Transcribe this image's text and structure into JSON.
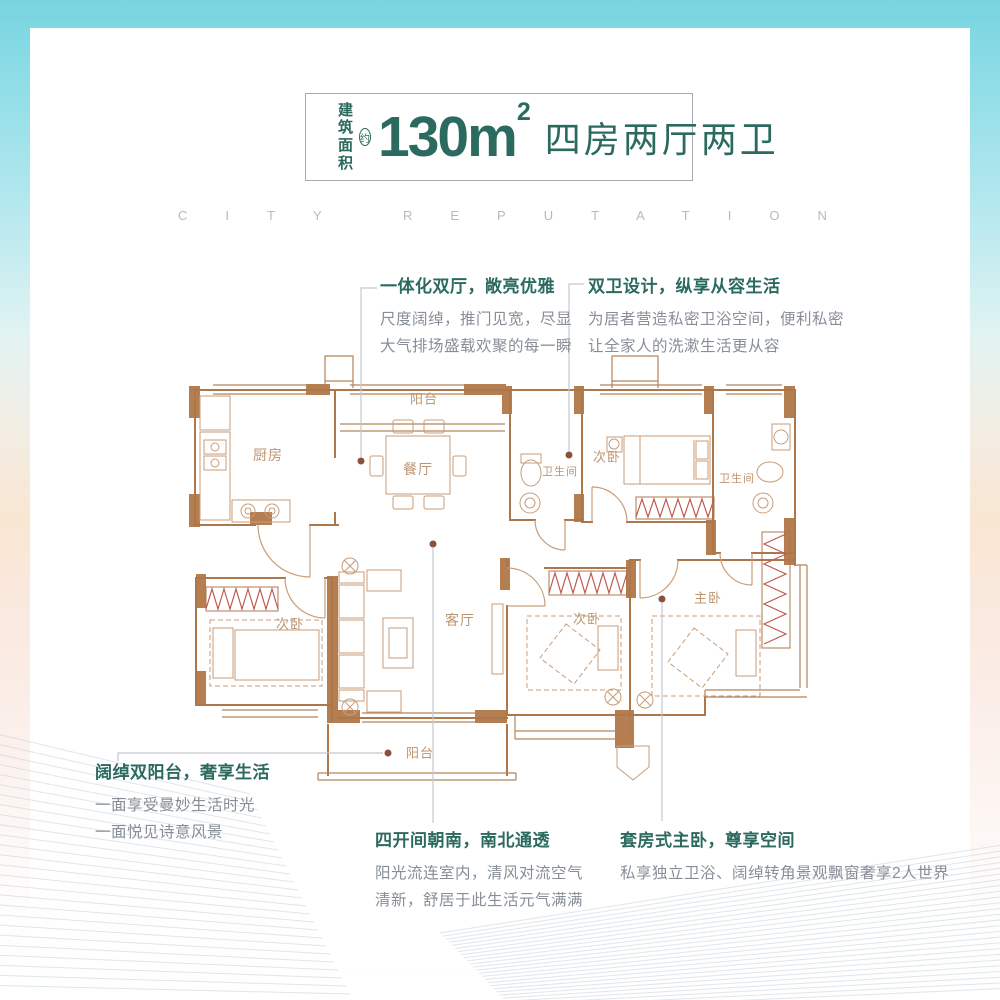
{
  "colors": {
    "teal": "#2b6a5e",
    "wall_brown": "#b57e50",
    "line_brown": "#ad774c",
    "furniture_tan": "#c99d77",
    "zigzag_red": "#c05a50",
    "body_gray": "#878e97",
    "room_label_brown": "#bd9470",
    "watermark_gray": "#b5bac2",
    "frame_cyan": "#7ed7e2",
    "leader_gray": "#c3c8cf",
    "leader_dot": "#8a523c"
  },
  "header": {
    "area_label_line1": "建筑",
    "area_label_line2": "面积",
    "approx_badge": "约",
    "area_value": "130",
    "area_unit": "m",
    "area_exponent": "2",
    "layout_text": "四房两厅两卫"
  },
  "watermark": "CITY REPUTATION",
  "callouts": {
    "top_left": {
      "title": "一体化双厅，敞亮优雅",
      "line1": "尺度阔绰，推门见宽，尽显",
      "line2": "大气排场盛载欢聚的每一瞬"
    },
    "top_right": {
      "title": "双卫设计，纵享从容生活",
      "line1": "为居者营造私密卫浴空间，便利私密",
      "line2": "让全家人的洗漱生活更从容"
    },
    "bottom_left": {
      "title": "阔绰双阳台，奢享生活",
      "line1": "一面享受曼妙生活时光",
      "line2": "一面悦见诗意风景"
    },
    "bottom_middle": {
      "title": "四开间朝南，南北通透",
      "line1": "阳光流连室内，清风对流空气",
      "line2": "清新，舒居于此生活元气满满"
    },
    "bottom_right": {
      "title": "套房式主卧，尊享空间",
      "line1": "私享独立卫浴、阔绰转角景观飘窗奢享2人世界",
      "line2": ""
    }
  },
  "floorplan": {
    "rooms": [
      {
        "id": "kitchen",
        "label": "厨房",
        "x": 268,
        "y": 455,
        "size": 14
      },
      {
        "id": "balcony-top",
        "label": "阳台",
        "x": 424,
        "y": 398,
        "size": 13
      },
      {
        "id": "dining",
        "label": "餐厅",
        "x": 418,
        "y": 469,
        "size": 14
      },
      {
        "id": "bathroom-1",
        "label": "卫生间",
        "x": 560,
        "y": 471,
        "size": 11
      },
      {
        "id": "bedroom-2",
        "label": "次卧",
        "x": 607,
        "y": 456,
        "size": 13
      },
      {
        "id": "bathroom-2",
        "label": "卫生间",
        "x": 737,
        "y": 478,
        "size": 11
      },
      {
        "id": "bedroom-3",
        "label": "次卧",
        "x": 290,
        "y": 623,
        "size": 13
      },
      {
        "id": "living",
        "label": "客厅",
        "x": 460,
        "y": 620,
        "size": 14
      },
      {
        "id": "bedroom-4",
        "label": "次卧",
        "x": 587,
        "y": 618,
        "size": 13
      },
      {
        "id": "master-bedroom",
        "label": "主卧",
        "x": 708,
        "y": 597,
        "size": 13
      },
      {
        "id": "balcony-bottom",
        "label": "阳台",
        "x": 420,
        "y": 752,
        "size": 13
      }
    ]
  }
}
